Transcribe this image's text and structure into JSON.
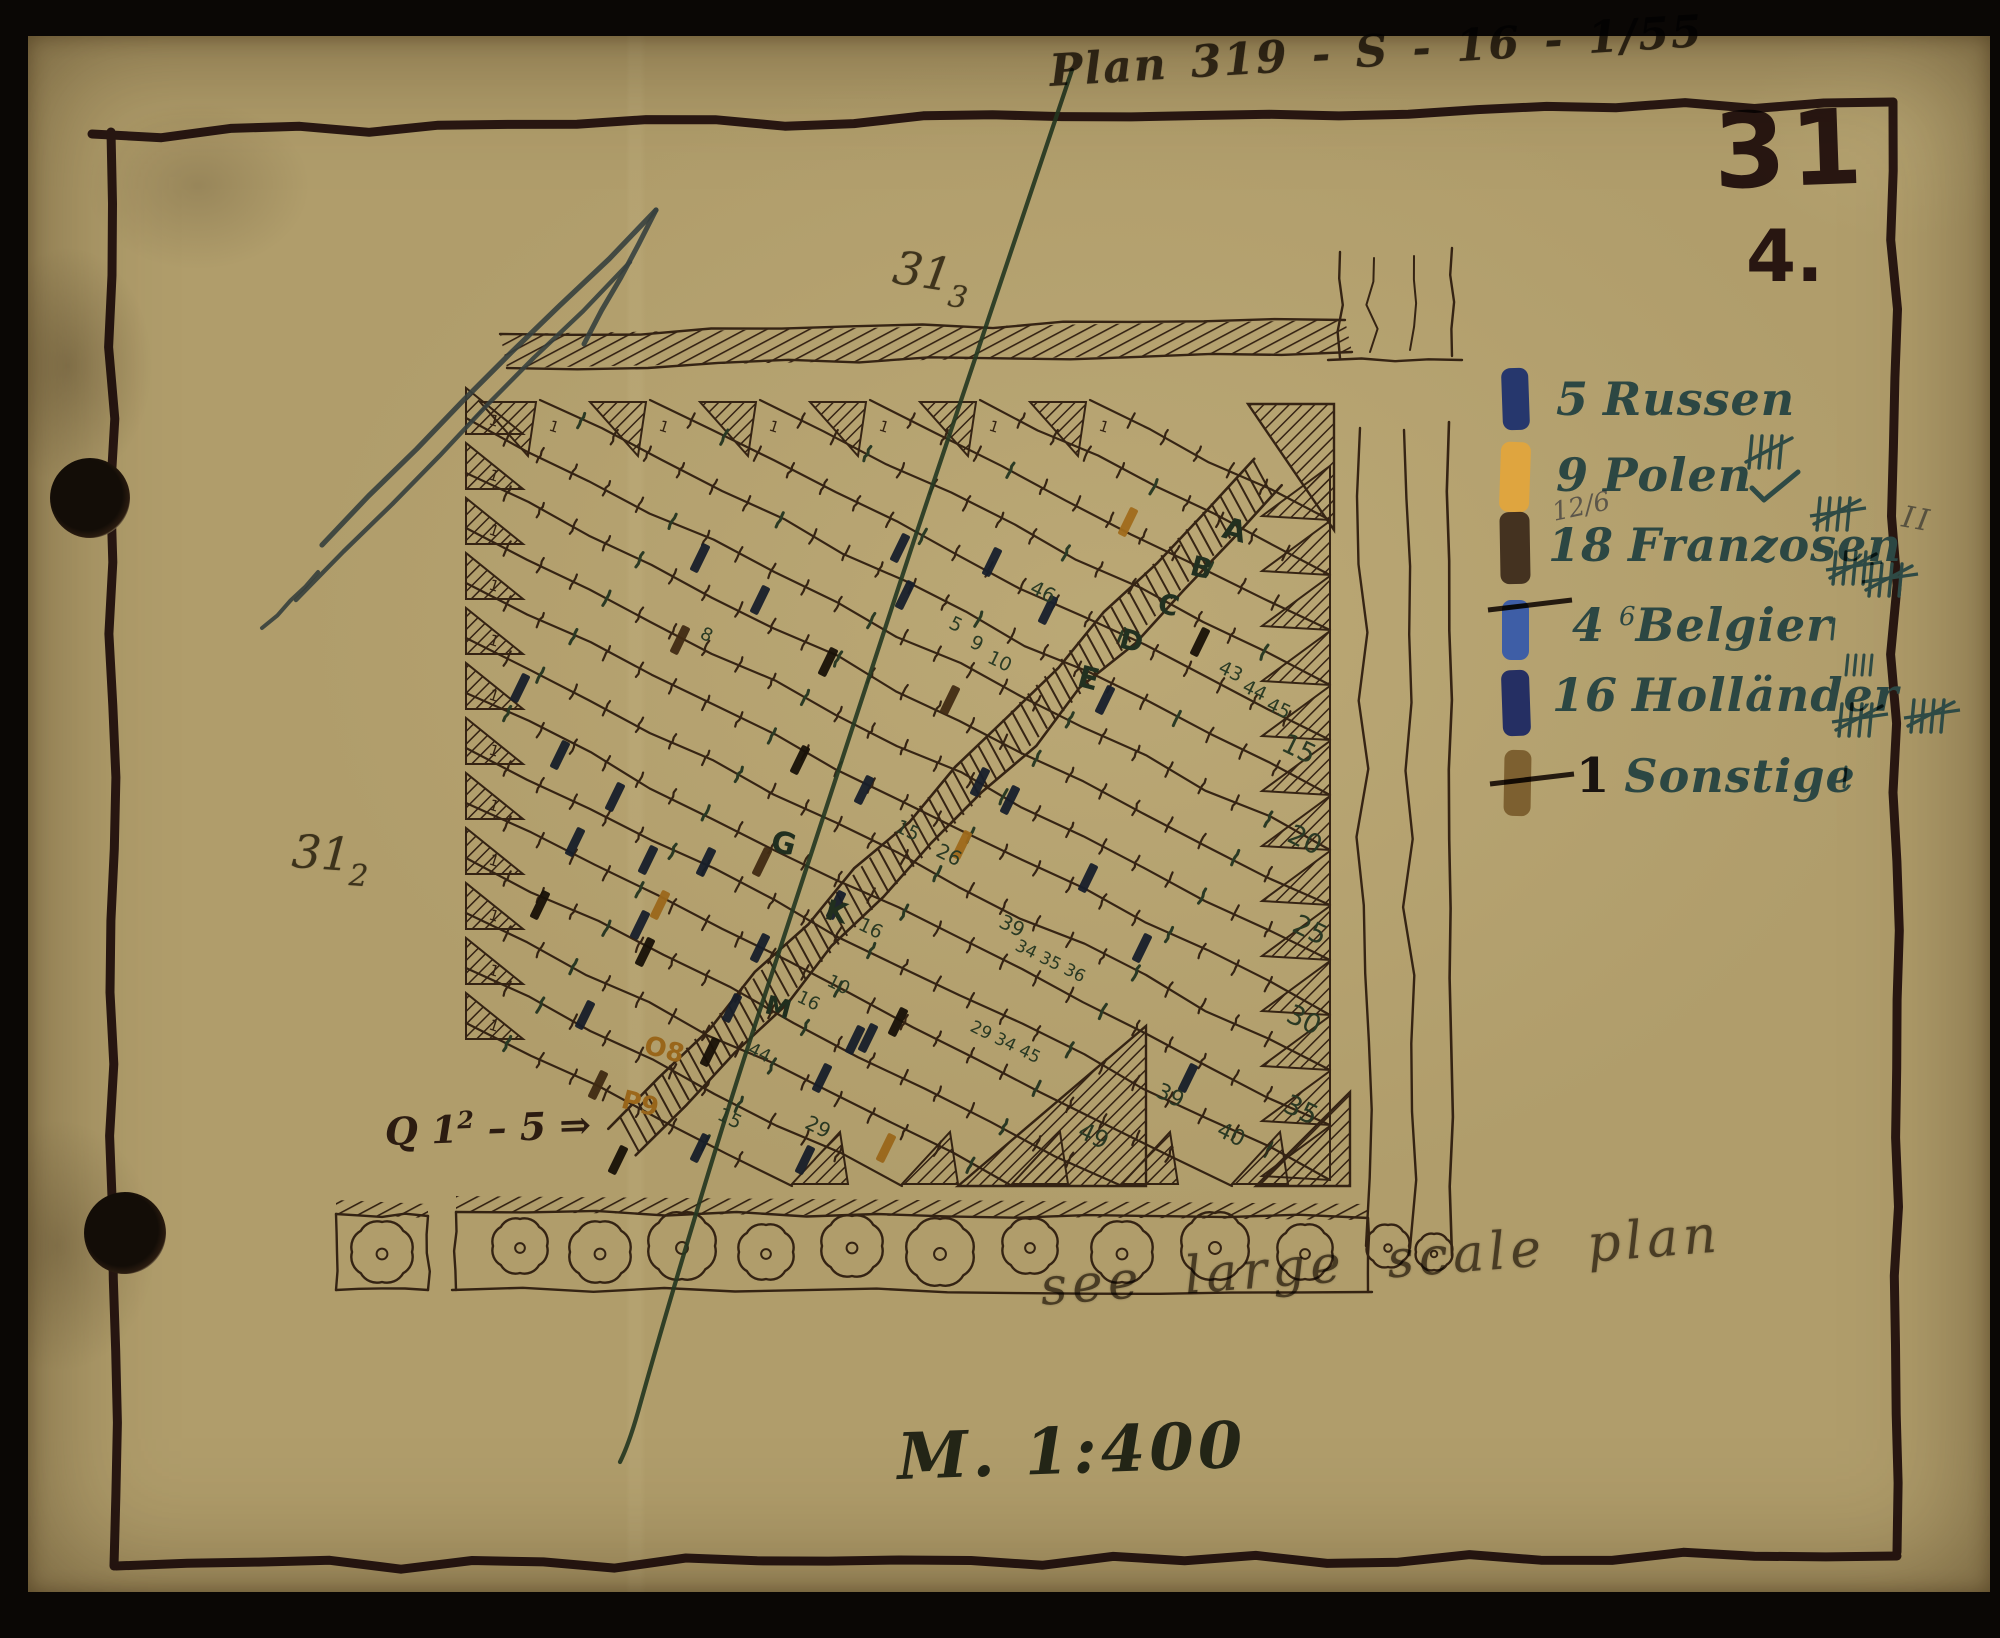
{
  "document": {
    "plan_ref": "Plan 319 - S - 16 - 1/55",
    "sheet_number": "31",
    "sheet_sub": "4.",
    "pencil_top": "31",
    "pencil_top_sub": "3",
    "pencil_left": "31",
    "pencil_left_sub": "2",
    "q_note": "Q 1",
    "q_note_sup": "2",
    "q_note_rest": " – 5 ⇒",
    "scale": "M. 1:400",
    "annotation": "see large scale plan"
  },
  "colors": {
    "navy": "#212f60",
    "orange": "#dda43c",
    "black": "#221a10",
    "brown": "#5c432a",
    "ink": "#4b382c",
    "teal": "#2e4a45",
    "numbers": "#3b5a50",
    "pencil": "#56504a",
    "frame": "#3b252a",
    "green_line": "#35594c",
    "blue_arrow": "#4f6790",
    "paper": "#b09d6b"
  },
  "legend": {
    "items": [
      {
        "count": "5",
        "label": "Russen",
        "swatch": "#26376d"
      },
      {
        "count": "9",
        "label": "Polen",
        "swatch": "#dfa53f",
        "tally_above": "plain",
        "check": true
      },
      {
        "count": "18",
        "label": "Franzosen",
        "swatch": "#443220",
        "pencil_note": "12/6",
        "tally_above": "struck",
        "tally_after_struck": 2,
        "outside_mark": "II"
      },
      {
        "count": "4",
        "sup": "6",
        "label": "Belgier",
        "swatch": "#3e5ea6",
        "swatch_strike": true,
        "tick_after": true
      },
      {
        "count": "16",
        "label": "Holländer",
        "swatch": "#252f63",
        "ticks_above": 4,
        "tally_after_struck": 1,
        "outside_tally": true
      },
      {
        "count": "1",
        "label": "Sonstige",
        "swatch": "#7d6030",
        "swatch_strike": true,
        "tick_after": true,
        "count_black": true
      }
    ]
  },
  "plan": {
    "start_number": "1",
    "letters": [
      {
        "t": "A",
        "x": 1232,
        "y": 540,
        "s": 30
      },
      {
        "t": "B",
        "x": 1199,
        "y": 577,
        "s": 28
      },
      {
        "t": "C",
        "x": 1166,
        "y": 614,
        "s": 28
      },
      {
        "t": "D",
        "x": 1129,
        "y": 650,
        "s": 28
      },
      {
        "t": "E",
        "x": 1086,
        "y": 688,
        "s": 30
      },
      {
        "t": "G",
        "x": 781,
        "y": 853,
        "s": 30
      },
      {
        "t": "K",
        "x": 834,
        "y": 921,
        "s": 28
      },
      {
        "t": "M",
        "x": 776,
        "y": 1016,
        "s": 26
      },
      {
        "t": "O8",
        "x": 662,
        "y": 1058,
        "s": 26,
        "o": true
      },
      {
        "t": "P9",
        "x": 638,
        "y": 1112,
        "s": 26,
        "o": true
      }
    ],
    "numbers": [
      {
        "t": "46",
        "x": 1040,
        "y": 598,
        "s": 20
      },
      {
        "t": "5",
        "x": 953,
        "y": 630,
        "s": 19
      },
      {
        "t": "9",
        "x": 974,
        "y": 649,
        "s": 19
      },
      {
        "t": "10",
        "x": 997,
        "y": 667,
        "s": 19
      },
      {
        "t": "43",
        "x": 1228,
        "y": 677,
        "s": 19
      },
      {
        "t": "44",
        "x": 1252,
        "y": 696,
        "s": 19
      },
      {
        "t": "45",
        "x": 1276,
        "y": 714,
        "s": 19
      },
      {
        "t": "15",
        "x": 1295,
        "y": 757,
        "s": 27
      },
      {
        "t": "20",
        "x": 1301,
        "y": 848,
        "s": 27
      },
      {
        "t": "25",
        "x": 1306,
        "y": 938,
        "s": 27
      },
      {
        "t": "30",
        "x": 1300,
        "y": 1028,
        "s": 27
      },
      {
        "t": "35",
        "x": 1297,
        "y": 1118,
        "s": 27
      },
      {
        "t": "26",
        "x": 946,
        "y": 861,
        "s": 20
      },
      {
        "t": "15",
        "x": 905,
        "y": 836,
        "s": 19
      },
      {
        "t": "16",
        "x": 868,
        "y": 934,
        "s": 19
      },
      {
        "t": "39",
        "x": 1009,
        "y": 932,
        "s": 20
      },
      {
        "t": "34 35 36",
        "x": 1048,
        "y": 966,
        "s": 17
      },
      {
        "t": "29 34 45",
        "x": 1003,
        "y": 1047,
        "s": 17
      },
      {
        "t": "10",
        "x": 836,
        "y": 990,
        "s": 18
      },
      {
        "t": "16",
        "x": 806,
        "y": 1006,
        "s": 18
      },
      {
        "t": "44",
        "x": 757,
        "y": 1058,
        "s": 18
      },
      {
        "t": "15",
        "x": 727,
        "y": 1124,
        "s": 19
      },
      {
        "t": "29",
        "x": 815,
        "y": 1133,
        "s": 20
      },
      {
        "t": "49",
        "x": 1090,
        "y": 1143,
        "s": 24
      },
      {
        "t": "39",
        "x": 1167,
        "y": 1102,
        "s": 22
      },
      {
        "t": "40",
        "x": 1228,
        "y": 1141,
        "s": 22
      },
      {
        "t": "8",
        "x": 704,
        "y": 640,
        "s": 18
      }
    ],
    "marks": [
      [
        900,
        548,
        "nv"
      ],
      [
        992,
        562,
        "nv"
      ],
      [
        700,
        558,
        "nv"
      ],
      [
        760,
        600,
        "nv"
      ],
      [
        1048,
        610,
        "nv"
      ],
      [
        560,
        755,
        "nv"
      ],
      [
        615,
        797,
        "nv"
      ],
      [
        575,
        842,
        "nv"
      ],
      [
        648,
        860,
        "nv"
      ],
      [
        706,
        862,
        "nv"
      ],
      [
        864,
        790,
        "nv"
      ],
      [
        980,
        782,
        "nv"
      ],
      [
        1088,
        878,
        "nv"
      ],
      [
        1142,
        948,
        "nv"
      ],
      [
        1188,
        1078,
        "nv"
      ],
      [
        868,
        1038,
        "nv"
      ],
      [
        822,
        1078,
        "nv"
      ],
      [
        760,
        948,
        "nv"
      ],
      [
        732,
        1008,
        "nv"
      ],
      [
        520,
        688,
        "nv"
      ],
      [
        905,
        595,
        "nv"
      ],
      [
        1105,
        700,
        "nv"
      ],
      [
        836,
        905,
        "nv"
      ],
      [
        640,
        925,
        "nv"
      ],
      [
        585,
        1015,
        "nv"
      ],
      [
        700,
        1148,
        "nv"
      ],
      [
        805,
        1160,
        "nv"
      ],
      [
        1010,
        800,
        "nv"
      ],
      [
        855,
        1040,
        "nv"
      ],
      [
        800,
        760,
        "bk"
      ],
      [
        645,
        952,
        "bk"
      ],
      [
        710,
        1052,
        "bk"
      ],
      [
        1200,
        642,
        "bk"
      ],
      [
        828,
        662,
        "bk"
      ],
      [
        898,
        1022,
        "bk"
      ],
      [
        540,
        905,
        "bk"
      ],
      [
        618,
        1160,
        "bk"
      ],
      [
        1128,
        522,
        "or"
      ],
      [
        962,
        845,
        "or"
      ],
      [
        660,
        905,
        "or"
      ],
      [
        886,
        1148,
        "or"
      ],
      [
        680,
        640,
        "br"
      ],
      [
        762,
        862,
        "br"
      ],
      [
        950,
        700,
        "br"
      ],
      [
        598,
        1085,
        "br"
      ]
    ]
  }
}
